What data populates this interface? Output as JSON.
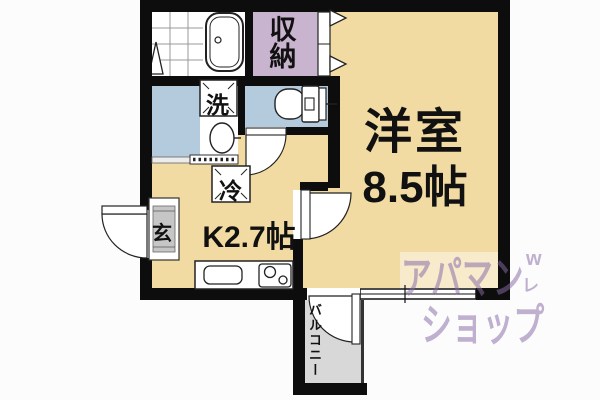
{
  "floor_plan": {
    "western_room": {
      "name": "洋室",
      "size": "8.5帖"
    },
    "kitchen": {
      "label": "K2.7帖"
    },
    "closet": {
      "label": "収納"
    },
    "washer": {
      "label": "洗"
    },
    "fridge": {
      "label": "冷"
    },
    "entrance": {
      "label": "玄"
    },
    "balcony": {
      "label": "バルコニー"
    },
    "fixtures": [
      "bathtub-icon",
      "shower-tile-icon",
      "toilet-icon",
      "washbasin-icon",
      "kitchen-sink-icon",
      "stove-icon",
      "door-swing-icon",
      "folding-door-icon",
      "sliding-door-icon",
      "window-icon"
    ],
    "colors": {
      "room_tan": "#f1dba2",
      "closet_lavender": "#c9b4cf",
      "wet_area_blue": "#b4cadd",
      "balcony_gray": "#d8d8d8",
      "genkan_gray": "#c6c6c6",
      "wall_black": "#0d0d0d",
      "watermark_purple": "#846aa3"
    },
    "watermark": {
      "line1": "アパマン",
      "line2": "ショップ",
      "mark_top": "w",
      "mark_bottom": "レ"
    }
  }
}
